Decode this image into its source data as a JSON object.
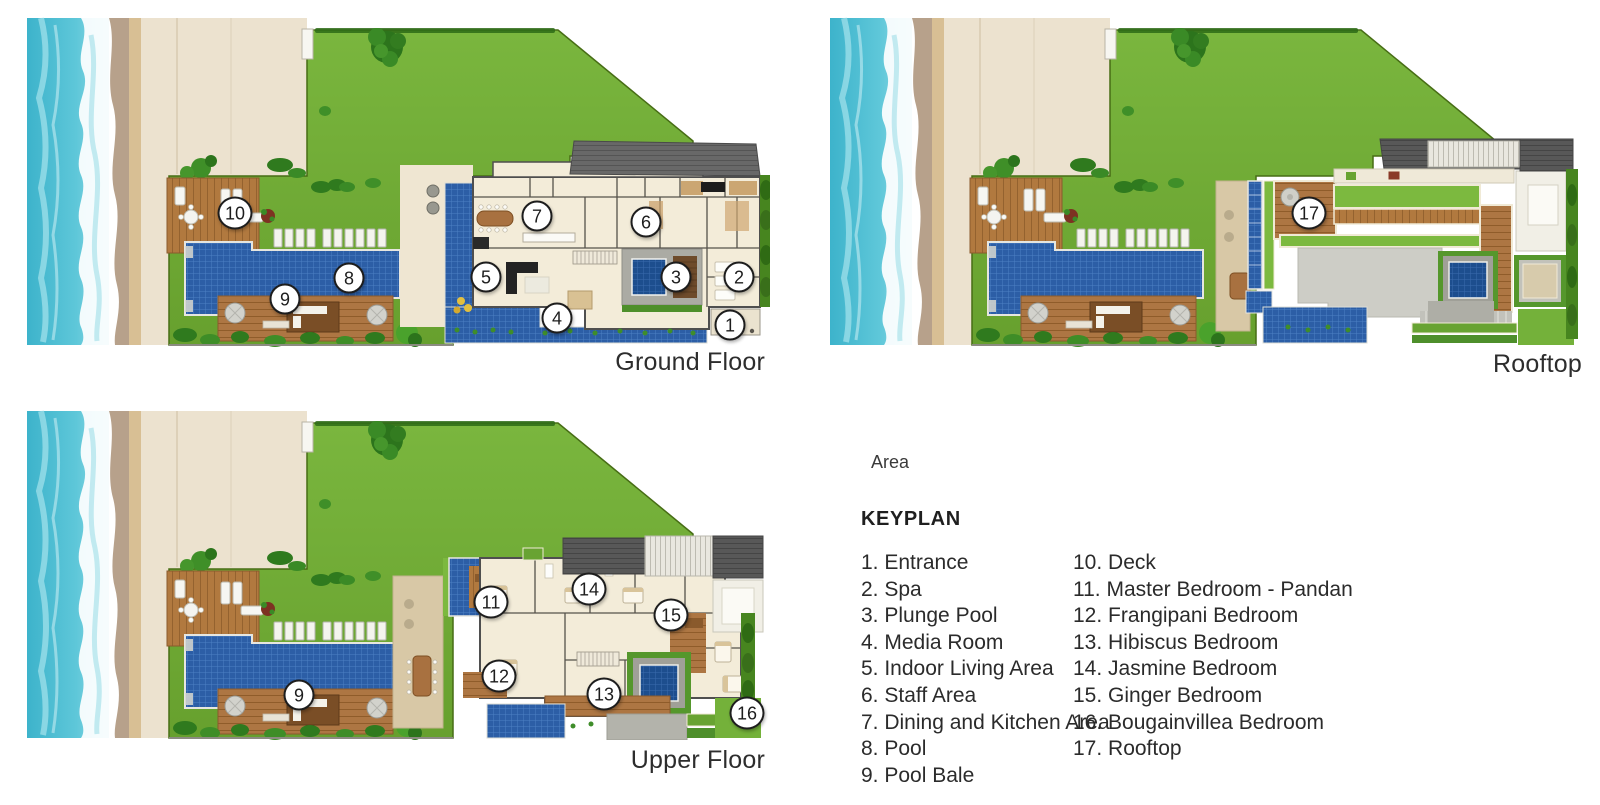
{
  "plans": [
    {
      "label": "Ground Floor",
      "markers": [
        {
          "n": "1",
          "x": 705,
          "y": 310
        },
        {
          "n": "2",
          "x": 714,
          "y": 262
        },
        {
          "n": "3",
          "x": 651,
          "y": 262
        },
        {
          "n": "4",
          "x": 532,
          "y": 303
        },
        {
          "n": "5",
          "x": 461,
          "y": 262
        },
        {
          "n": "6",
          "x": 621,
          "y": 207
        },
        {
          "n": "7",
          "x": 512,
          "y": 201
        },
        {
          "n": "8",
          "x": 324,
          "y": 263
        },
        {
          "n": "9",
          "x": 260,
          "y": 284
        },
        {
          "n": "10",
          "x": 210,
          "y": 198
        }
      ]
    },
    {
      "label": "Rooftop",
      "markers": [
        {
          "n": "17",
          "x": 481,
          "y": 198
        }
      ]
    },
    {
      "label": "Upper Floor",
      "markers": [
        {
          "n": "9",
          "x": 274,
          "y": 287
        },
        {
          "n": "11",
          "x": 466,
          "y": 194
        },
        {
          "n": "12",
          "x": 474,
          "y": 268
        },
        {
          "n": "13",
          "x": 579,
          "y": 286
        },
        {
          "n": "14",
          "x": 564,
          "y": 181
        },
        {
          "n": "15",
          "x": 646,
          "y": 207
        },
        {
          "n": "16",
          "x": 722,
          "y": 305
        }
      ]
    }
  ],
  "keyplan": {
    "area_label": "Area",
    "title": "KEYPLAN",
    "columns": [
      {
        "items": [
          "1. Entrance",
          "2. Spa",
          "3. Plunge Pool",
          "4. Media Room",
          "5. Indoor Living Area",
          "6. Staff Area",
          "7. Dining and Kitchen Area",
          "8. Pool",
          "9. Pool Bale"
        ]
      },
      {
        "items": [
          "10. Deck",
          "11. Master Bedroom - Pandan",
          "12. Frangipani Bedroom",
          "13. Hibiscus Bedroom",
          "14. Jasmine Bedroom",
          "15. Ginger Bedroom",
          "16. Bougainvillea Bedroom",
          "17. Rooftop"
        ]
      }
    ]
  },
  "colors": {
    "ocean": "#45b8ce",
    "foam": "#ffffff",
    "wet_sand": "#b7a18b",
    "gold_sand": "#d8bf94",
    "sand": "#ece2cf",
    "lawn": "#74b13a",
    "tree": "#2f7a1e",
    "deck_wood": "#b1793f",
    "pool_water": "#2c5ea6",
    "dark_pool": "#1d4e8e",
    "building": "#f3ecd9",
    "wall": "#4f4f4f",
    "roof": "#686868",
    "concrete": "#cdcdc6",
    "green_roof": "#7cb93f",
    "courtyard": "#d8c8a6",
    "marker_bg": "#ffffff",
    "marker_border": "#1d1d1d",
    "label_text": "#2d2d2d"
  }
}
